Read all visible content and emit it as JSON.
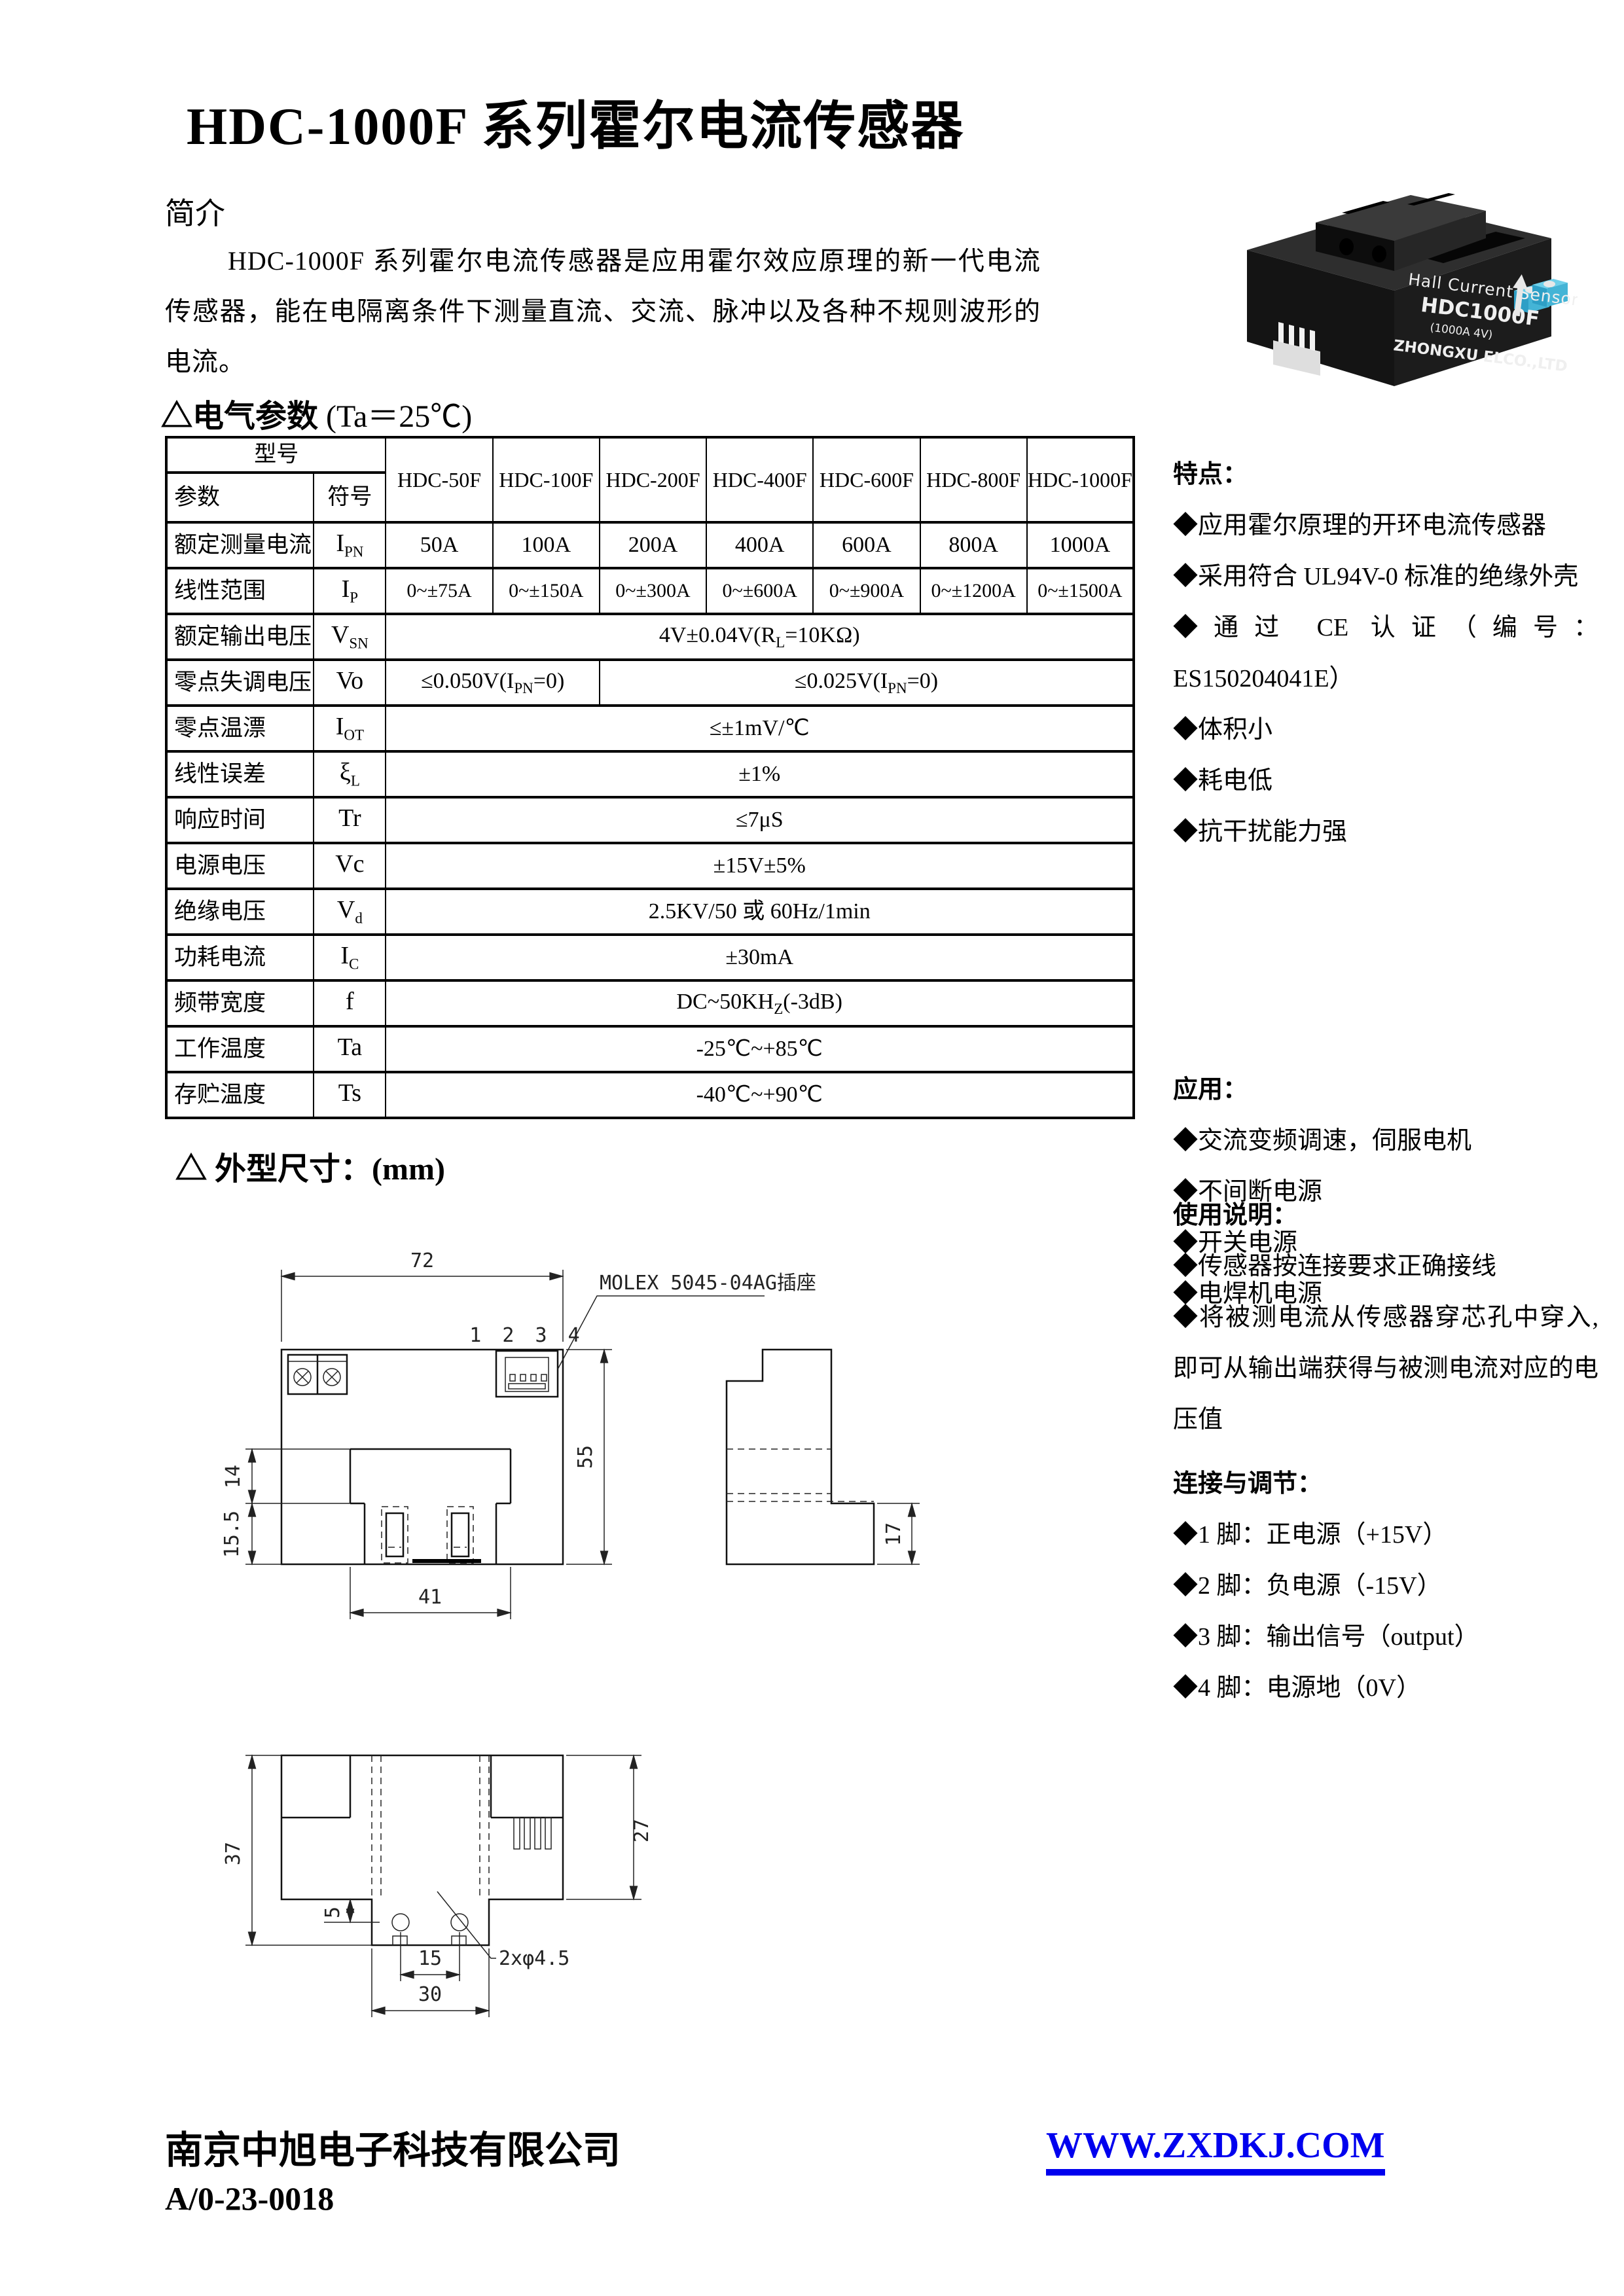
{
  "page": {
    "title": "HDC-1000F 系列霍尔电流传感器",
    "intro": {
      "heading": "简介",
      "body": "HDC-1000F 系列霍尔电流传感器是应用霍尔效应原理的新一代电流传感器，能在电隔离条件下测量直流、交流、脉冲以及各种不规则波形的电流。"
    },
    "footer": {
      "company": "南京中旭电子科技有限公司",
      "doc_number": "A/0-23-0018",
      "website": "WWW.ZXDKJ.COM"
    },
    "colors": {
      "link_blue": "#0000EE",
      "terminal_blue": "#45B8DC"
    }
  },
  "params": {
    "heading": "△电气参数",
    "condition": "(Ta＝25℃)",
    "table": {
      "corner": {
        "model": "型号",
        "param": "参数",
        "symbol": "符号"
      },
      "models": [
        "HDC-50F",
        "HDC-100F",
        "HDC-200F",
        "HDC-400F",
        "HDC-600F",
        "HDC-800F",
        "HDC-1000F"
      ],
      "rows": {
        "ipn": {
          "label": "额定测量电流",
          "sym": "I",
          "sub": "PN",
          "values": [
            "50A",
            "100A",
            "200A",
            "400A",
            "600A",
            "800A",
            "1000A"
          ]
        },
        "ip": {
          "label": "线性范围",
          "sym": "I",
          "sub": "P",
          "values": [
            "0~±75A",
            "0~±150A",
            "0~±300A",
            "0~±600A",
            "0~±900A",
            "0~±1200A",
            "0~±1500A"
          ]
        },
        "vsn": {
          "label": "额定输出电压",
          "sym": "V",
          "sub": "SN",
          "pre": "4V±0.04V(R",
          "vsub": "L",
          "post": "=10KΩ)"
        },
        "vo": {
          "label": "零点失调电压",
          "sym": "Vo",
          "sub": "",
          "v1pre": "≤0.050V(I",
          "v1sub": "PN",
          "v1post": "=0)",
          "v2pre": "≤0.025V(I",
          "v2sub": "PN",
          "v2post": "=0)"
        },
        "iot": {
          "label": "零点温漂",
          "sym": "I",
          "sub": "OT",
          "value": "≤±1mV/℃"
        },
        "xil": {
          "label": "线性误差",
          "sym": "ξ",
          "sub": "L",
          "value": "±1%"
        },
        "tr": {
          "label": "响应时间",
          "sym": "Tr",
          "sub": "",
          "value": "≤7μS"
        },
        "vc": {
          "label": "电源电压",
          "sym": "Vc",
          "sub": "",
          "value": "±15V±5%"
        },
        "vd": {
          "label": "绝缘电压",
          "sym": "V",
          "sub": "d",
          "value": "2.5KV/50 或 60Hz/1min"
        },
        "ic": {
          "label": "功耗电流",
          "sym": "I",
          "sub": "C",
          "value": "±30mA"
        },
        "f": {
          "label": "频带宽度",
          "sym": "f",
          "sub": "",
          "pre": "DC~50KH",
          "vsub": "Z",
          "post": "(-3dB)"
        },
        "ta": {
          "label": "工作温度",
          "sym": "Ta",
          "sub": "",
          "value": "-25℃~+85℃"
        },
        "ts": {
          "label": "存贮温度",
          "sym": "Ts",
          "sub": "",
          "value": "-40℃~+90℃"
        }
      }
    }
  },
  "sidebar": {
    "features": {
      "heading": "特点：",
      "items": [
        "◆应用霍尔原理的开环电流传感器",
        "◆采用符合 UL94V-0 标准的绝缘外壳",
        "◆通过 CE 认证（编号：ES150204041E）",
        "◆体积小",
        "◆耗电低",
        "◆抗干扰能力强"
      ]
    },
    "applications": {
      "heading": "应用：",
      "items": [
        "◆交流变频调速，伺服电机",
        "◆不间断电源",
        "◆开关电源",
        "◆电焊机电源"
      ]
    },
    "usage": {
      "heading": "使用说明：",
      "items": [
        "◆传感器按连接要求正确接线",
        "◆将被测电流从传感器穿芯孔中穿入,即可从输出端获得与被测电流对应的电压值"
      ]
    },
    "connection": {
      "heading": "连接与调节：",
      "items": [
        "◆1 脚：正电源（+15V）",
        "◆2 脚：负电源（-15V）",
        "◆3 脚：输出信号（output）",
        "◆4 脚：电源地（0V）"
      ]
    }
  },
  "photo": {
    "line1": "Hall Current Sensor",
    "line2": "HDC1000F",
    "line3": "(1000A 4V)",
    "line4": "ZHONGXU ELCO.,LTD"
  },
  "dims": {
    "heading": "△ 外型尺寸：",
    "unit": "(mm)",
    "labels": {
      "connector": "MOLEX 5045-04AG插座",
      "pins": "1 2 3 4",
      "d72": "72",
      "d55": "55",
      "d14": "14",
      "d155": "15.5",
      "d41": "41",
      "d17": "17",
      "d37": "37",
      "d27": "27",
      "d5": "5",
      "d15": "15",
      "d30": "30",
      "holes": "2xφ4.5"
    }
  }
}
